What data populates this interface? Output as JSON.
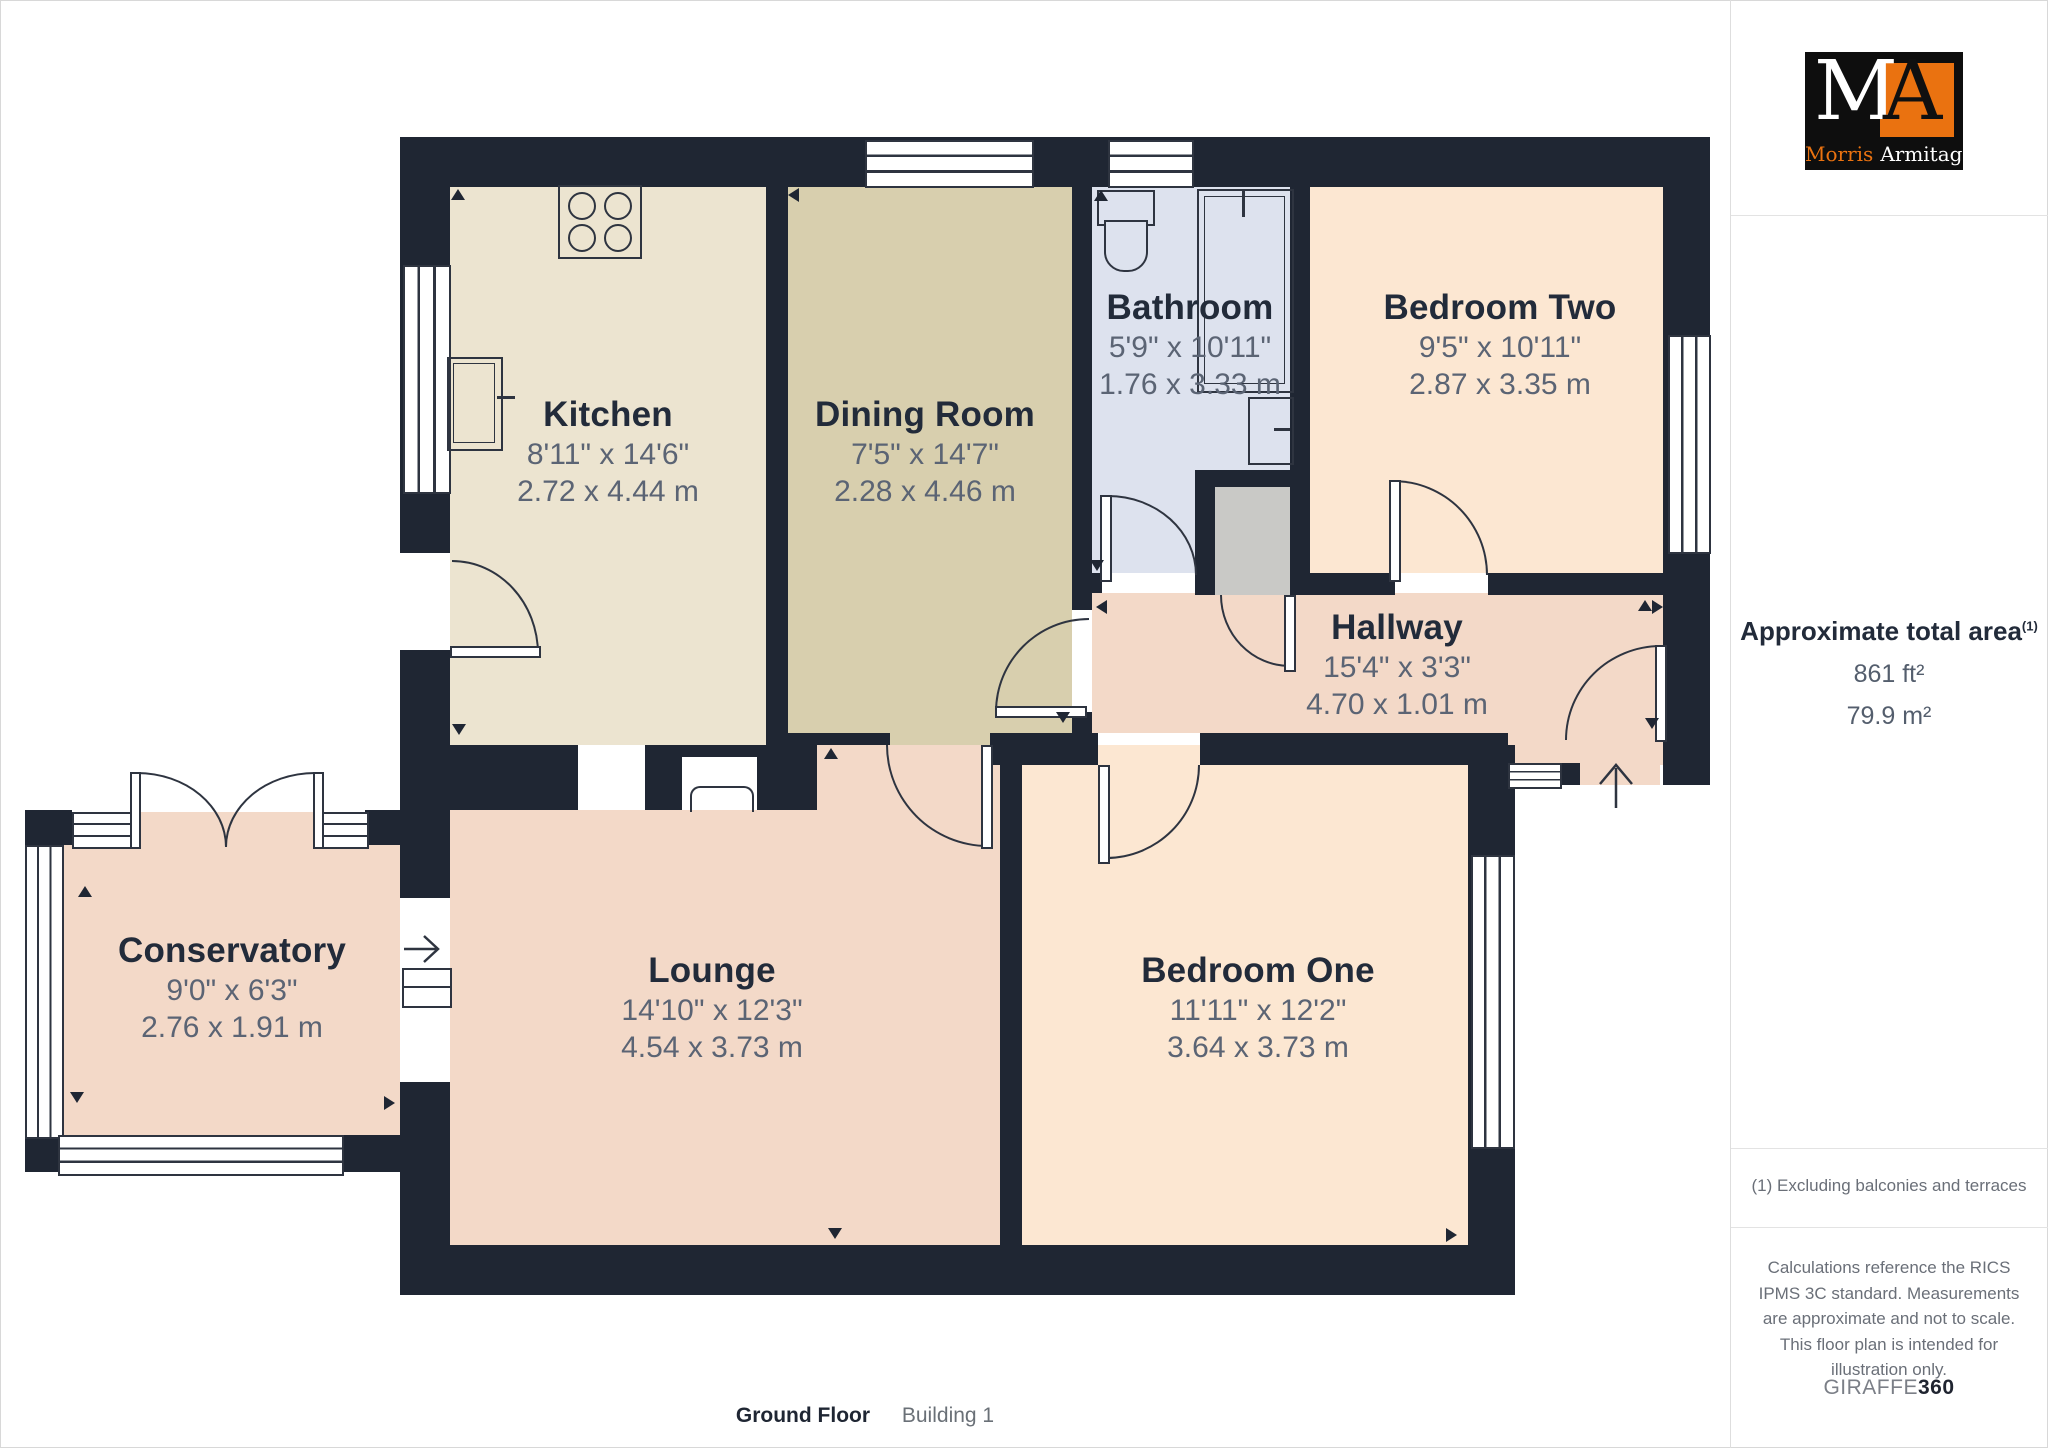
{
  "branding": {
    "logo_m": "M",
    "logo_a": "A",
    "logo_name_first": "Morris",
    "logo_name_last": "Armitage"
  },
  "sidebar": {
    "area_title": "Approximate total area",
    "area_sup": "(1)",
    "area_ft": "861 ft²",
    "area_m": "79.9 m²",
    "footnote": "(1) Excluding balconies and terraces",
    "disclaimer": "Calculations reference the RICS IPMS 3C standard. Measurements are approximate and not to scale. This floor plan is intended for illustration only.",
    "brand_giraffe": "GIRAFFE",
    "brand_360": "360"
  },
  "footer": {
    "floor_label": "Ground Floor",
    "building_label": "Building 1"
  },
  "rooms": [
    {
      "name": "Kitchen",
      "imperial": "8'11\" x 14'6\"",
      "metric": "2.72 x 4.44 m"
    },
    {
      "name": "Dining Room",
      "imperial": "7'5\" x 14'7\"",
      "metric": "2.28 x 4.46 m"
    },
    {
      "name": "Bathroom",
      "imperial": "5'9\" x 10'11\"",
      "metric": "1.76 x 3.33 m"
    },
    {
      "name": "Bedroom Two",
      "imperial": "9'5\" x 10'11\"",
      "metric": "2.87 x 3.35 m"
    },
    {
      "name": "Hallway",
      "imperial": "15'4\" x 3'3\"",
      "metric": "4.70 x 1.01 m"
    },
    {
      "name": "Conservatory",
      "imperial": "9'0\" x 6'3\"",
      "metric": "2.76 x 1.91 m"
    },
    {
      "name": "Lounge",
      "imperial": "14'10\" x 12'3\"",
      "metric": "4.54 x 3.73 m"
    },
    {
      "name": "Bedroom One",
      "imperial": "11'11\" x 12'2\"",
      "metric": "3.64 x 3.73 m"
    }
  ],
  "colors": {
    "wall": "#1f2633",
    "kitchen_floor": "#ece4d0",
    "dining_floor": "#d8cfae",
    "bathroom_floor": "#dde2ee",
    "bedroom_floor": "#fce7d2",
    "living_floor": "#f3d9c8",
    "cupboard": "#c9c9c6",
    "logo_orange": "#ea7210",
    "logo_black": "#0e0e0e"
  }
}
